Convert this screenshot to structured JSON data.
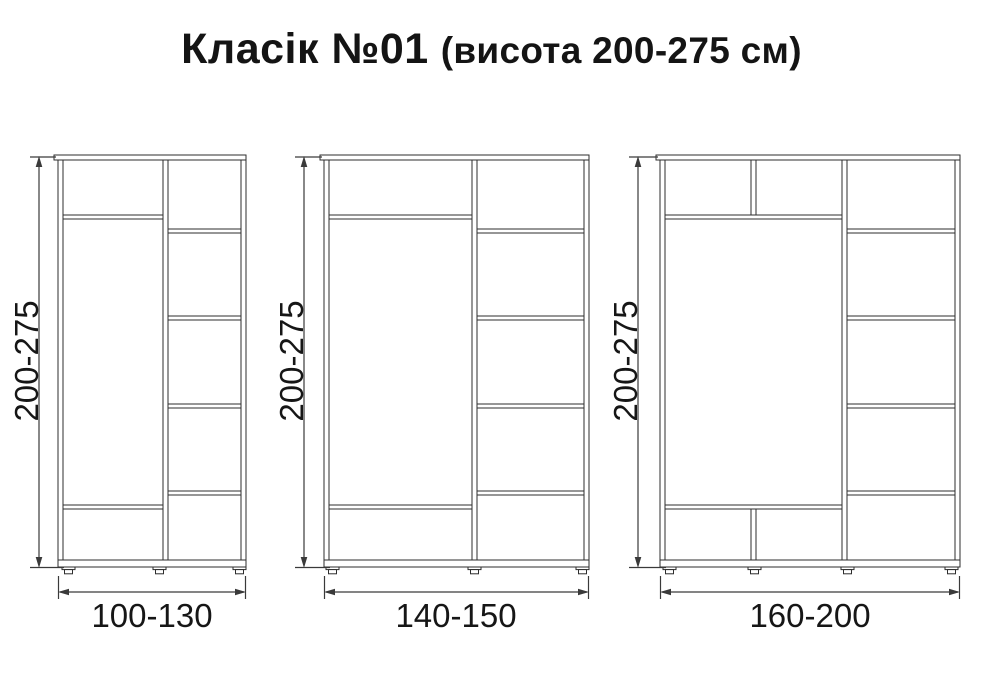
{
  "title": {
    "main": "Класік №01",
    "sub": "(висота 200-275 см)"
  },
  "wardrobes": [
    {
      "height_label": "200-275",
      "width_label": "100-130"
    },
    {
      "height_label": "200-275",
      "width_label": "140-150"
    },
    {
      "height_label": "200-275",
      "width_label": "160-200"
    }
  ],
  "colors": {
    "background": "#ffffff",
    "panel_line": "#2e2e2e",
    "dimension_line": "#3a3a3a",
    "text": "#141414"
  }
}
